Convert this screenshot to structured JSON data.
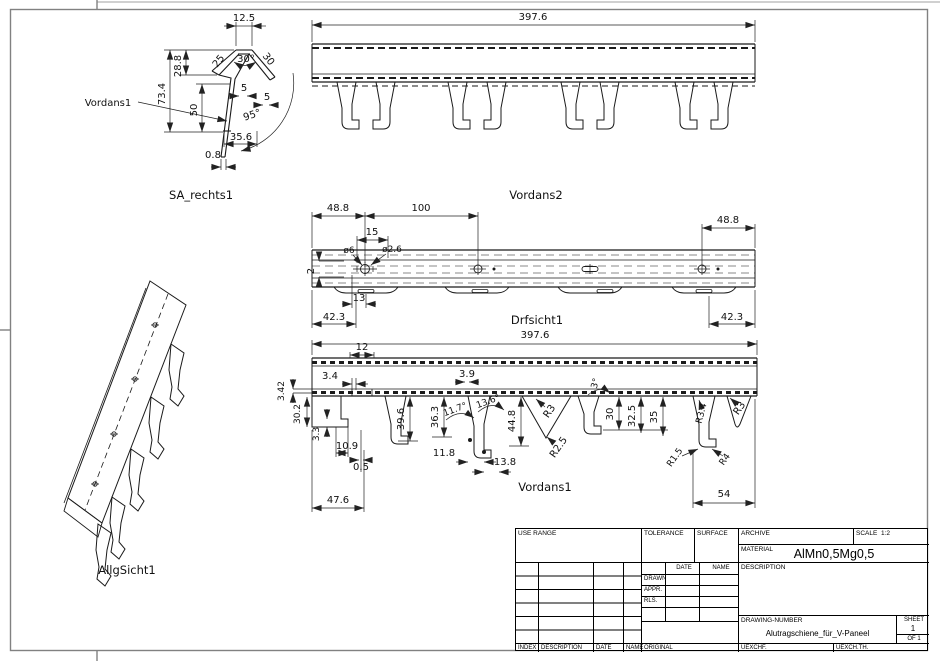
{
  "views": {
    "sa_rechts1": {
      "caption": "SA_rechts1",
      "leader_label": "Vordans1",
      "dims": {
        "cap_width": "12.5",
        "upper_height": "28.8",
        "total_height": "73.4",
        "web_height": "50",
        "left_flange_len": "25",
        "v_angle": "30°",
        "right_flange_len": "30",
        "left_wall": "5",
        "right_wall": "5",
        "web_angle": "95°",
        "base_width": "35.6",
        "wall_thickness": "0.8"
      }
    },
    "vordans2": {
      "caption": "Vordans2",
      "dims": {
        "length": "397.6"
      }
    },
    "drfsicht1": {
      "caption": "Drfsicht1",
      "dims": {
        "left_end_offset": "48.8",
        "hole_pitch": "100",
        "slot_length": "15",
        "center_offset": "2",
        "hole_dia": "ø6",
        "pilot_hole_dia": "ø2.6",
        "slot_pos": "13",
        "left_foot_offset": "42.3",
        "right_end_offset": "48.8",
        "right_foot_offset": "42.3"
      }
    },
    "vordans1": {
      "caption": "Vordans1",
      "dims": {
        "length": "397.6",
        "slot_width": "12",
        "lip": "3.4",
        "web": "3.9",
        "band": "3.42",
        "left_depth": "30.2",
        "foot_h": "3.3",
        "foot_w": "10.9",
        "gap": "0.5",
        "left_span": "47.6",
        "h1": "39.6",
        "h2": "36.3",
        "a1": "11.7°",
        "a2": "13.6°",
        "w1": "11.8",
        "w2": "13.8",
        "h3": "44.8",
        "r_top": "R3",
        "r_notch": "R2.5",
        "a3": "3°",
        "h4": "30",
        "h5": "32.5",
        "h6": "35",
        "r_side": "R3.4",
        "r_top2": "R3",
        "r_foot1": "R1.5",
        "r_foot2": "R4",
        "right_span": "54"
      }
    },
    "allgsicht1": {
      "caption": "AllgSicht1"
    }
  },
  "title_block": {
    "use_range": "USE RANGE",
    "tolerance": "TOLERANCE",
    "surface": "SURFACE",
    "archive": "ARCHIVE",
    "scale_label": "SCALE",
    "scale_value": "1:2",
    "material_label": "MATERIAL",
    "material_value": "AlMn0,5Mg0,5",
    "date": "DATE",
    "name": "NAME",
    "description": "DESCRIPTION",
    "drawn": "DRAWN",
    "appr": "APPR.",
    "rls": "RLS.",
    "drawing_number_label": "DRAWING-NUMBER",
    "drawing_number_value": "Alutragschiene_für_V-Paneel",
    "sheet_label": "SHEET",
    "sheet_value": "1",
    "of_value": "OF 1",
    "index": "INDEX",
    "description2": "DESCRIPTION",
    "date2": "DATE",
    "name2": "NAME",
    "original": "ORIGINAL",
    "uexchf": "UEXCHF.",
    "uexchth": "UEXCH.TH."
  }
}
